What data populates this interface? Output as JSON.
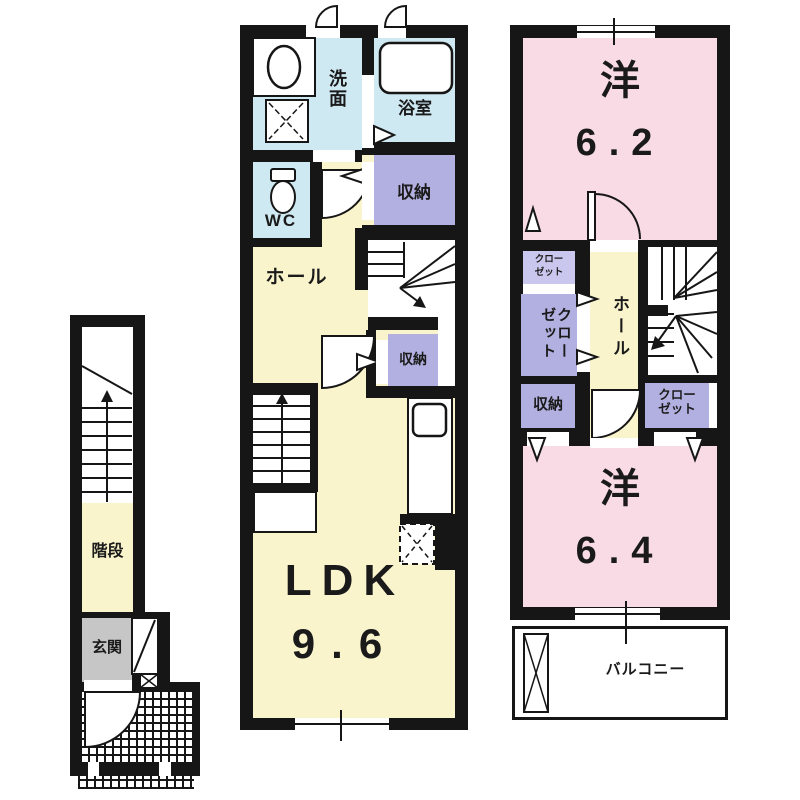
{
  "colors": {
    "wall": "#161616",
    "wet_room": "#cfe9f3",
    "storage_purple": "#b2b0e0",
    "closet_light_purple": "#c9c7ee",
    "hall_yellow": "#faf4cc",
    "bedroom_pink": "#f9dbe6",
    "entrance_gray": "#c6c6c6",
    "line": "#1a1a1a"
  },
  "f1": {
    "stairs": "階段",
    "entrance": "玄関"
  },
  "f2": {
    "washroom": "洗面",
    "bathroom": "浴室",
    "toilet": "WC",
    "storage_top": "収納",
    "hall": "ホール",
    "storage_mid": "収納",
    "ldk_name": "LDK",
    "ldk_size": "9.6"
  },
  "f3": {
    "bedroom_top_name": "洋",
    "bedroom_top_size": "6.2",
    "closet_small_line1": "クロー",
    "closet_small_line2": "ゼット",
    "closet_left": "クローゼット",
    "hall": "ホール",
    "storage": "収納",
    "closet_right_line1": "クロー",
    "closet_right_line2": "ゼット",
    "bedroom_bottom_name": "洋",
    "bedroom_bottom_size": "6.4",
    "balcony": "バルコニー"
  }
}
